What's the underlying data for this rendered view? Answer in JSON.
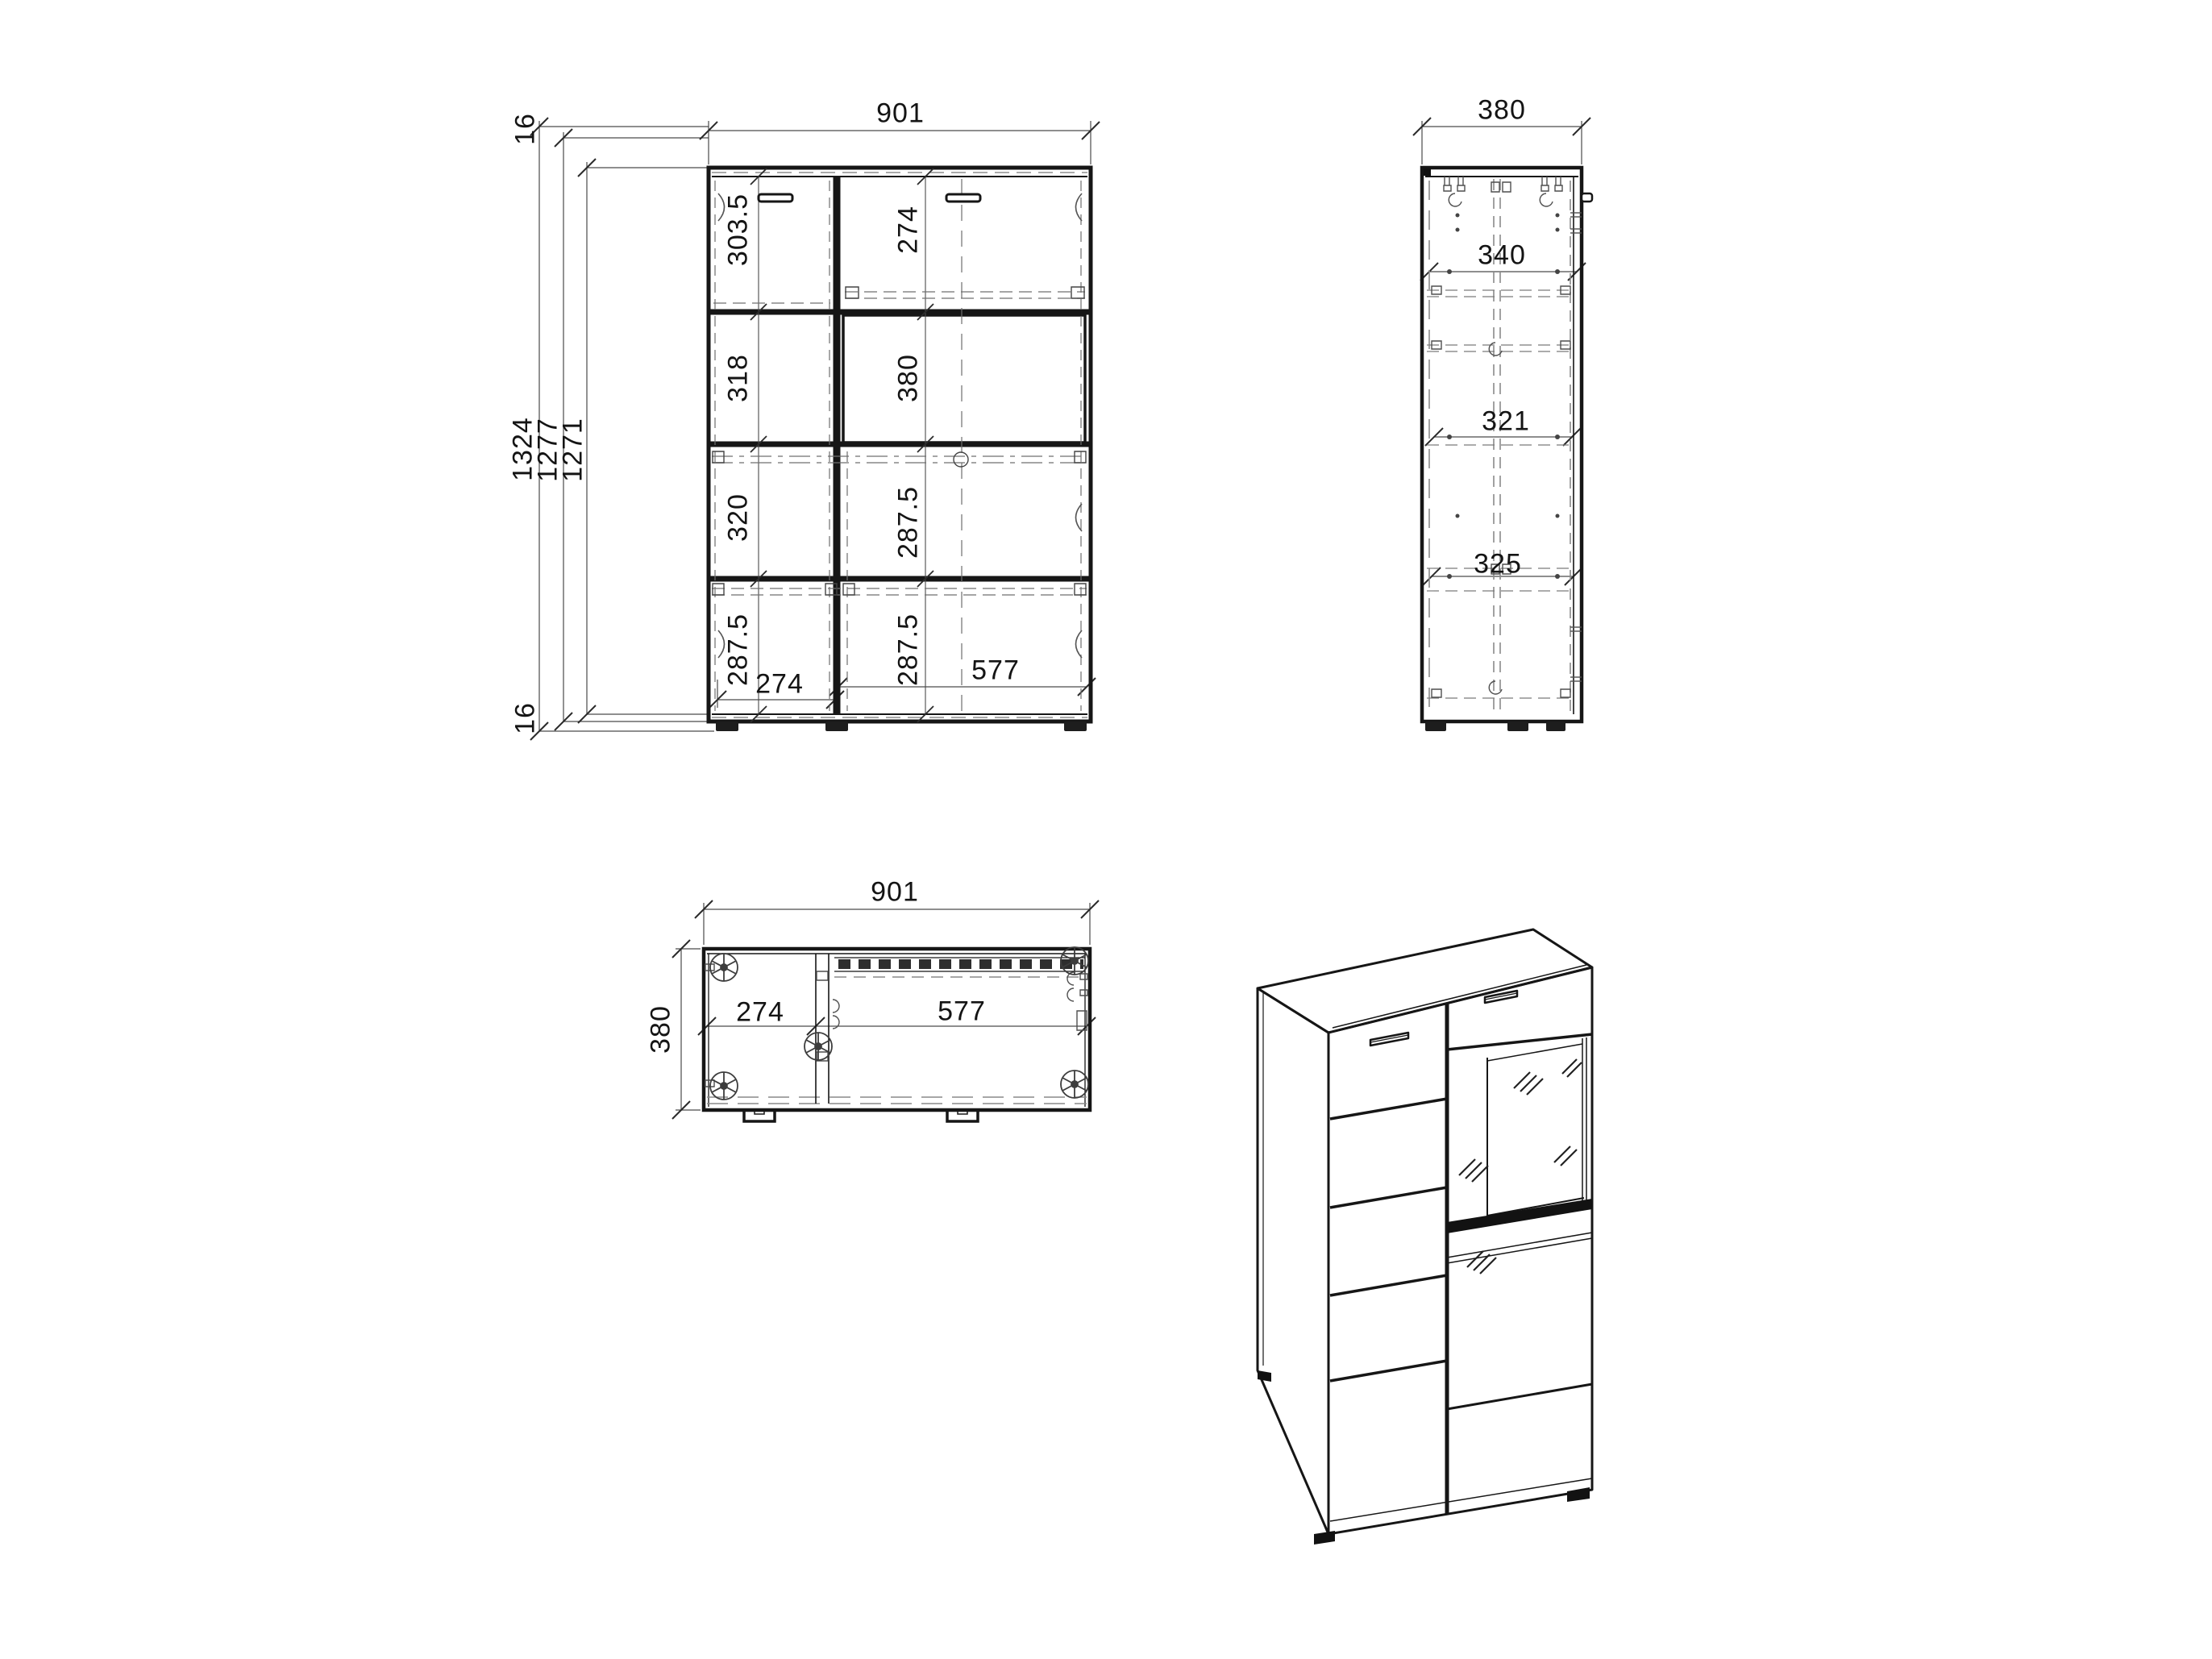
{
  "front_view": {
    "width_dim": "901",
    "board_top": "16",
    "board_bottom": "16",
    "height_dims": [
      "1324",
      "1277",
      "1271"
    ],
    "left_column_cells": [
      "303.5",
      "318",
      "320",
      "287.5"
    ],
    "right_column_cells": [
      "274",
      "380",
      "287.5",
      "287.5"
    ],
    "bottom_widths": {
      "left": "274",
      "right": "577"
    }
  },
  "side_view": {
    "depth_dim": "380",
    "internal_dims": [
      "340",
      "321",
      "325"
    ]
  },
  "top_view": {
    "width_dim": "901",
    "depth_dim": "380",
    "left_width": "274",
    "right_width": "577"
  }
}
